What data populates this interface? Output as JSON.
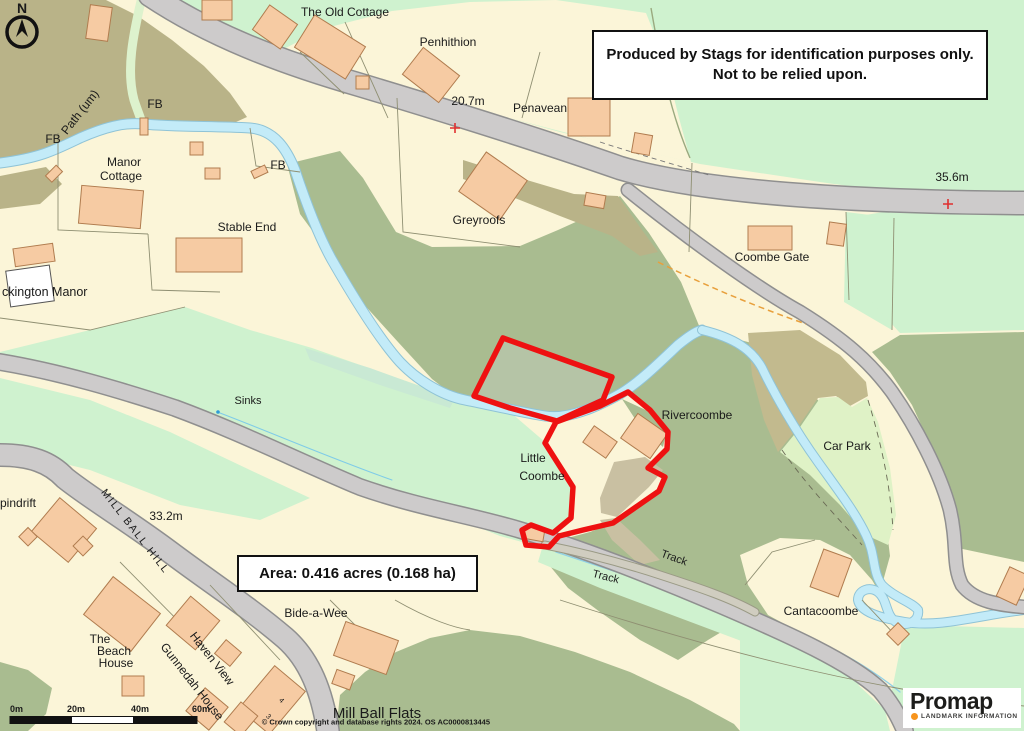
{
  "title": "Promap site location plan",
  "colors": {
    "cream": "#FBF5D8",
    "light_green": "#CFF2CF",
    "pale_field": "#DFF2C6",
    "sage": "#A9BC90",
    "sage_light": "#B5C4A6",
    "olive": "#B9B388",
    "tan_yard": "#C9C0A2",
    "road": "#CDCBCB",
    "road_casing": "#8F8F8F",
    "river": "#C3EBF8",
    "river_edge": "#8FC3D6",
    "building": "#F6CBA3",
    "building_edge": "#B07C4F",
    "boundary_red": "#EE1111",
    "text": "#1A1A1A",
    "water_text": "#2E9BD6",
    "path_orange": "#E8A03C",
    "logo_orange": "#F7941D"
  },
  "disclaimer": {
    "line1": "Produced by Stags for identification purposes only.",
    "line2": "Not to be relied upon."
  },
  "area_label": "Area: 0.416 acres (0.168 ha)",
  "compass_n": "N",
  "scale_bar": {
    "t0": "0m",
    "t1": "20m",
    "t2": "40m",
    "t3": "60m"
  },
  "copyright": "© Crown copyright and database rights 2024. OS AC0000813445",
  "logo": {
    "brand": "Promap",
    "tagline": "LANDMARK INFORMATION"
  },
  "labels": [
    {
      "text": "The Old Cottage"
    },
    {
      "text": "Penhithion"
    },
    {
      "text": "20.7m"
    },
    {
      "text": "Penavean"
    },
    {
      "text": "Greyroofs"
    },
    {
      "text": "Coombe Gate"
    },
    {
      "text": "35.6m"
    },
    {
      "text": "Manor"
    },
    {
      "text": "Cottage"
    },
    {
      "text": "Stable End"
    },
    {
      "text": "FB"
    },
    {
      "text": "FB"
    },
    {
      "text": "FB"
    },
    {
      "text": "Path (um)"
    },
    {
      "text": "ckington Manor"
    },
    {
      "text": "Sinks"
    },
    {
      "text": "Rivercoombe"
    },
    {
      "text": "Little"
    },
    {
      "text": "Coombe"
    },
    {
      "text": "Car Park"
    },
    {
      "text": "pindrift"
    },
    {
      "text": "MILL BALL HILL"
    },
    {
      "text": "33.2m"
    },
    {
      "text": "Bide-a-Wee"
    },
    {
      "text": "The"
    },
    {
      "text": "Beach"
    },
    {
      "text": "House"
    },
    {
      "text": "Haven View"
    },
    {
      "text": "Gunnedah House"
    },
    {
      "text": "Mill Ball Flats"
    },
    {
      "text": "Track"
    },
    {
      "text": "Track"
    },
    {
      "text": "Cantacoombe"
    },
    {
      "text": "4"
    },
    {
      "text": "3"
    }
  ]
}
